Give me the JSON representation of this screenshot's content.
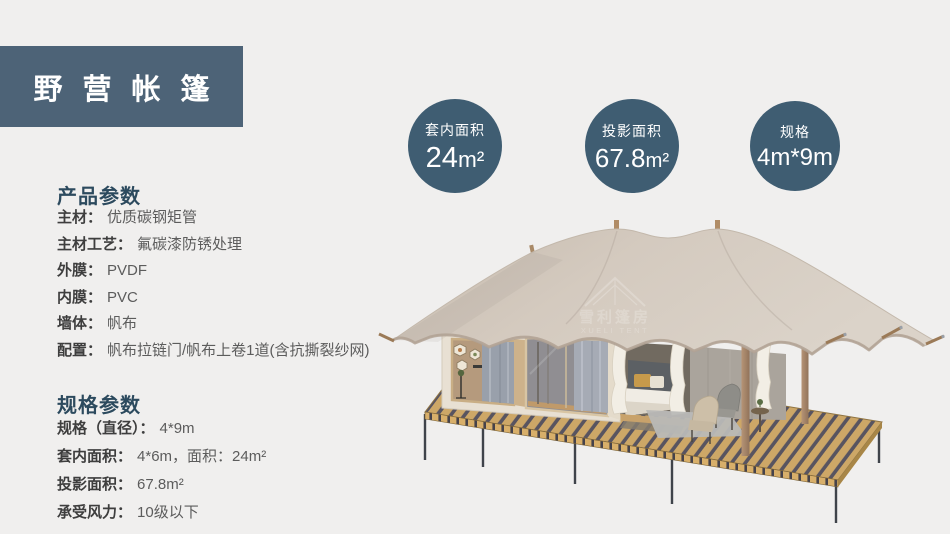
{
  "title": {
    "text": "野营帐篷"
  },
  "badges": [
    {
      "label": "套内面积",
      "value": "24",
      "unit": "m²"
    },
    {
      "label": "投影面积",
      "value": "67.8",
      "unit": "m²"
    },
    {
      "label": "规格",
      "value": "4m*9m",
      "unit": ""
    }
  ],
  "product": {
    "heading": "产品参数",
    "rows": [
      {
        "label": "主材：",
        "value": "优质碳钢矩管"
      },
      {
        "label": "主材工艺：",
        "value": "氟碳漆防锈处理"
      },
      {
        "label": "外膜：",
        "value": "PVDF"
      },
      {
        "label": "内膜：",
        "value": "PVC"
      },
      {
        "label": "墙体：",
        "value": "帆布"
      },
      {
        "label": "配置：",
        "value": "帆布拉链门/帆布上卷1道(含抗撕裂纱网)"
      }
    ]
  },
  "specs": {
    "heading": "规格参数",
    "rows": [
      {
        "label": "规格（直径）：",
        "value": "4*9m"
      },
      {
        "label": "套内面积：",
        "value": "4*6m，面积：24m²"
      },
      {
        "label": "投影面积：",
        "value": "67.8m²"
      },
      {
        "label": "承受风力：",
        "value": "10级以下"
      }
    ]
  },
  "watermark": {
    "cn": "雪利篷房",
    "en": "XUELI TENT"
  },
  "colors": {
    "background": "#f0efee",
    "title_bg": "#4d6377",
    "circle_bg": "#3f5d72",
    "heading": "#2c4a5e",
    "roof_canvas": "#d3c9be",
    "deck_wood": "#cda767"
  }
}
